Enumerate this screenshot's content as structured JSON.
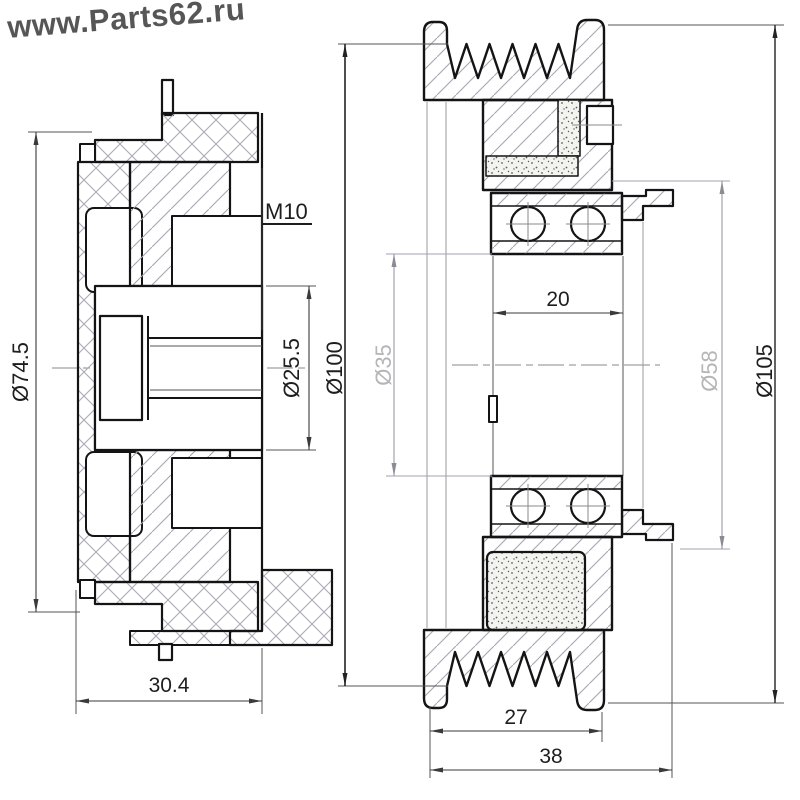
{
  "watermark": {
    "text": "www.Parts62.ru"
  },
  "left_view": {
    "outer_diameter": "Ø74.5",
    "thread": "M10",
    "bore_diameter": "Ø25.5",
    "width": "30.4"
  },
  "right_view": {
    "groove_diameter": "Ø100",
    "bore_diameter": "Ø35",
    "bearing_width": "20",
    "hub_diameter": "Ø58",
    "outer_diameter": "Ø105",
    "belt_section_width": "27",
    "overall_width": "38"
  },
  "colors": {
    "outline": "#141414",
    "dim_line": "#3a3a3a",
    "hatch": "#aaaab6",
    "light_label": "#b5b5b5",
    "dark_label": "#1e1e1e",
    "watermark": "#4a4a4a",
    "background": "#ffffff"
  }
}
